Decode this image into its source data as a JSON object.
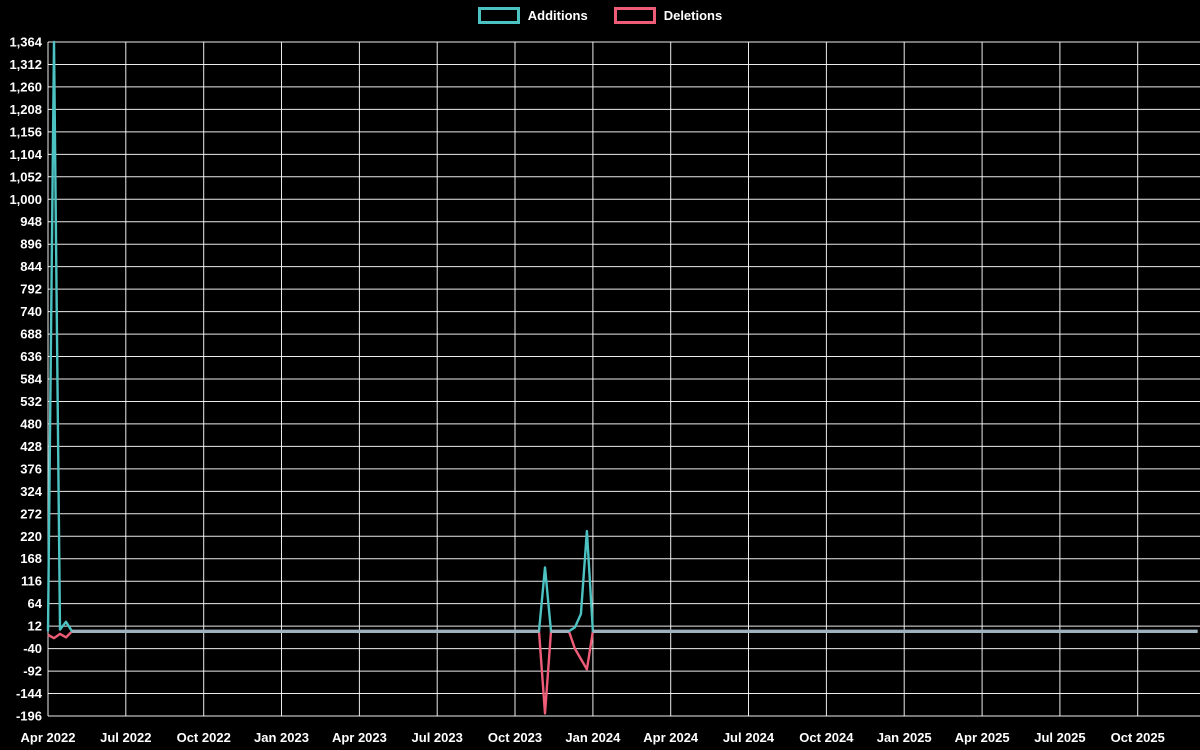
{
  "window": {
    "background": "#000000",
    "text_color": "#ffffff"
  },
  "legend": {
    "items": [
      {
        "label": "Additions",
        "color": "#4cc2c2"
      },
      {
        "label": "Deletions",
        "color": "#ee5c78"
      }
    ]
  },
  "chart_data": {
    "type": "line",
    "title": "",
    "xlabel": "",
    "ylabel": "",
    "grid": {
      "show": true,
      "line_color": "#ffffff",
      "zero_line_color": "#9fb2bf"
    },
    "x_axis": {
      "start_date": "2022-04-03",
      "weeks_total": 192.4,
      "tick_step_weeks": 13,
      "tick_labels": [
        "Apr 2022",
        "Jul 2022",
        "Oct 2022",
        "Jan 2023",
        "Apr 2023",
        "Jul 2023",
        "Oct 2023",
        "Jan 2024",
        "Apr 2024",
        "Jul 2024",
        "Oct 2024",
        "Jan 2025",
        "Apr 2025",
        "Jul 2025",
        "Oct 2025"
      ]
    },
    "y_axis": {
      "min": -196,
      "max": 1364,
      "step": 52,
      "tick_labels": [
        "-196",
        "-144",
        "-92",
        "-40",
        "12",
        "64",
        "116",
        "168",
        "220",
        "272",
        "324",
        "376",
        "428",
        "480",
        "532",
        "584",
        "636",
        "688",
        "740",
        "792",
        "844",
        "896",
        "948",
        "1,000",
        "1,052",
        "1,104",
        "1,156",
        "1,208",
        "1,260",
        "1,312",
        "1,364"
      ]
    },
    "dates": [
      "2022-04-03",
      "2022-04-10",
      "2022-04-17",
      "2022-04-24",
      "2022-05-01",
      "2023-10-29",
      "2023-11-05",
      "2023-11-12",
      "2023-12-03",
      "2023-12-10",
      "2023-12-17",
      "2023-12-24",
      "2023-12-31",
      "2025-12-07"
    ],
    "series": [
      {
        "name": "Additions",
        "color": "#4cc2c2",
        "values": [
          0,
          1364,
          4,
          22,
          0,
          0,
          148,
          0,
          0,
          9,
          40,
          232,
          0,
          0
        ]
      },
      {
        "name": "Deletions",
        "color": "#ee5c78",
        "values": [
          -8,
          -16,
          -6,
          -14,
          0,
          0,
          -190,
          0,
          0,
          -40,
          -64,
          -88,
          0,
          0
        ]
      }
    ]
  }
}
